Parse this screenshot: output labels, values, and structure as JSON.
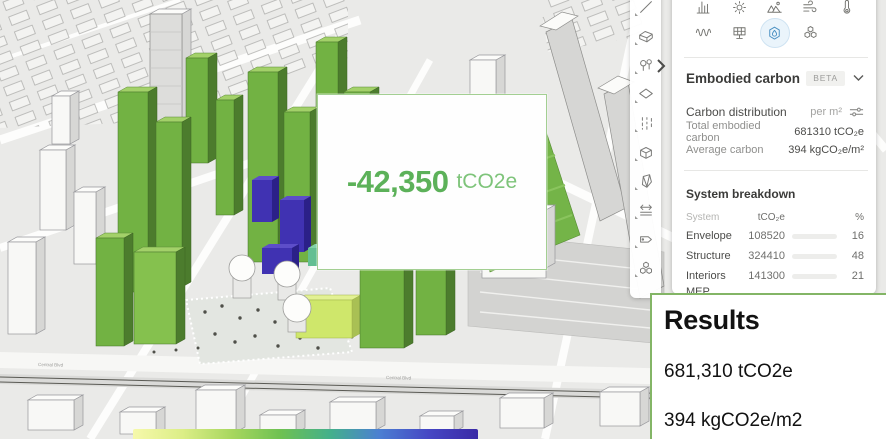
{
  "viewport": {
    "road_label": "Central Blvd",
    "legend_gradient": [
      "#f6f9ab",
      "#dcee87",
      "#a8d75f",
      "#6ec152",
      "#44b08b",
      "#4b7fd2",
      "#4647c4",
      "#3a2aa6"
    ]
  },
  "callout": {
    "value": "-42,350",
    "unit": "tCO2e"
  },
  "left_toolbar": {
    "tools": [
      "line",
      "volume",
      "vegetation",
      "surface",
      "road",
      "box",
      "prism",
      "measure",
      "label",
      "materials"
    ]
  },
  "panel": {
    "modules": {
      "row1": [
        "statistics",
        "sun",
        "terrain",
        "wind",
        "temperature"
      ],
      "row2": [
        "noise",
        "solar",
        "embodied-carbon",
        "materials"
      ],
      "selected": "embodied-carbon"
    },
    "title": "Embodied carbon",
    "badge": "BETA",
    "distribution": {
      "label": "Carbon distribution",
      "unit": "per m²",
      "rows": [
        {
          "label": "Total embodied carbon",
          "value": "681310 tCO₂e"
        },
        {
          "label": "Average carbon",
          "value": "394 kgCO₂e/m²"
        }
      ]
    },
    "breakdown": {
      "title": "System breakdown",
      "columns": {
        "system": "System",
        "value": "tCO₂e",
        "pct": "%"
      },
      "rows": [
        {
          "system": "Envelope",
          "value": "108520",
          "pct": 16,
          "color": "#b5484c"
        },
        {
          "system": "Structure",
          "value": "324410",
          "pct": 48,
          "color": "#d7d844"
        },
        {
          "system": "Interiors",
          "value": "141300",
          "pct": 21,
          "color": "#8ac341"
        },
        {
          "system": "MEP Systems",
          "value": "107090",
          "pct": 16,
          "color": "#3b9a9d"
        }
      ]
    }
  },
  "results": {
    "title": "Results",
    "total": "681,310 tCO2e",
    "average": "394 kgCO2e/m2"
  }
}
